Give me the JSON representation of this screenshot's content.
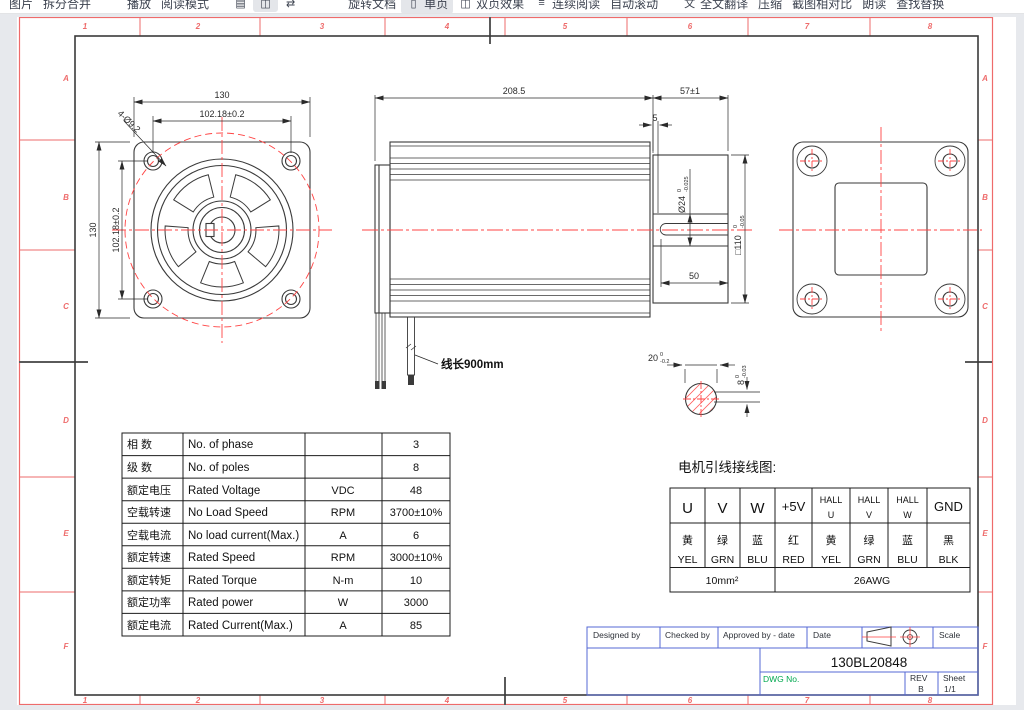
{
  "toolbar": {
    "items": [
      {
        "label": "图片"
      },
      {
        "label": "拆分合并"
      },
      {
        "label": "播放"
      },
      {
        "label": "阅读模式"
      },
      {
        "label": "旋转文档"
      },
      {
        "label": "单页"
      },
      {
        "label": "双页效果"
      },
      {
        "label": "连续阅读"
      },
      {
        "label": "自动滚动"
      },
      {
        "label": "全文翻译"
      },
      {
        "label": "压缩"
      },
      {
        "label": "截图相对比"
      },
      {
        "label": "朗读"
      },
      {
        "label": "查找替换"
      }
    ],
    "icons": {
      "page": "▤",
      "fit": "◫",
      "swap": "⇄",
      "single": "▯",
      "double": "◫",
      "continuous": "≡",
      "scroll": "⇅",
      "translate": "文"
    }
  },
  "sheet": {
    "zones_h": [
      "1",
      "2",
      "3",
      "4",
      "5",
      "6",
      "7",
      "8"
    ],
    "zones_v": [
      "A",
      "B",
      "C",
      "D",
      "E",
      "F"
    ]
  },
  "dims": {
    "front_width": "130",
    "front_bolt_h": "102.18±0.2",
    "front_height": "130",
    "front_bolt_v": "102.18±0.2",
    "front_holes": "4-Ø9.2",
    "body_len": "208.5",
    "shaft_len": "57±1",
    "step": "5",
    "shaft_dia_main": "Ø24",
    "shaft_dia_up": "0",
    "shaft_dia_low": "-0.025",
    "square_main": "□110",
    "square_up": "0",
    "square_low": "-0.05",
    "key_len": "50",
    "wire_note": "线长900mm",
    "key_w_main": "20",
    "key_w_up": "0",
    "key_w_low": "-0.2",
    "key_h_main": "8",
    "key_h_up": "0",
    "key_h_low": "-0.03"
  },
  "spec_table": {
    "rows": [
      {
        "cn": "相 数",
        "en": "No. of phase",
        "unit": "",
        "val": "3"
      },
      {
        "cn": "级 数",
        "en": "No. of poles",
        "unit": "",
        "val": "8"
      },
      {
        "cn": "额定电压",
        "en": "Rated Voltage",
        "unit": "VDC",
        "val": "48"
      },
      {
        "cn": "空载转速",
        "en": "No Load Speed",
        "unit": "RPM",
        "val": "3700±10%"
      },
      {
        "cn": "空载电流",
        "en": "No load current(Max.)",
        "unit": "A",
        "val": "6"
      },
      {
        "cn": "额定转速",
        "en": "Rated Speed",
        "unit": "RPM",
        "val": "3000±10%"
      },
      {
        "cn": "额定转矩",
        "en": "Rated Torque",
        "unit": "N-m",
        "val": "10"
      },
      {
        "cn": "额定功率",
        "en": "Rated power",
        "unit": "W",
        "val": "3000"
      },
      {
        "cn": "额定电流",
        "en": "Rated Current(Max.)",
        "unit": "A",
        "val": "85"
      }
    ]
  },
  "wiring": {
    "title": "电机引线接线图:",
    "row1": [
      "U",
      "V",
      "W",
      "+5V",
      "HALL",
      "HALL",
      "HALL",
      "GND"
    ],
    "row1b": [
      "",
      "",
      "",
      "",
      "U",
      "V",
      "W",
      ""
    ],
    "cn": [
      "黄",
      "绿",
      "蓝",
      "红",
      "黄",
      "绿",
      "蓝",
      "黑"
    ],
    "en": [
      "YEL",
      "GRN",
      "BLU",
      "RED",
      "YEL",
      "GRN",
      "BLU",
      "BLK"
    ],
    "gauge_left": "10mm²",
    "gauge_right": "26AWG"
  },
  "title_block": {
    "designed": "Designed by",
    "checked": "Checked by",
    "approved": "Approved by - date",
    "date": "Date",
    "scale": "Scale",
    "part_no": "130BL20848",
    "dwg_no": "DWG No.",
    "rev_label": "REV",
    "rev": "B",
    "sheet_label": "Sheet",
    "sheet": "1/1"
  },
  "colors": {
    "border_red": "#ee6b6b",
    "centerline_red": "#ff4343",
    "title_block_blue": "#5468d4",
    "dwg_green": "#00a84f",
    "line_dark": "#3a3a3a"
  }
}
